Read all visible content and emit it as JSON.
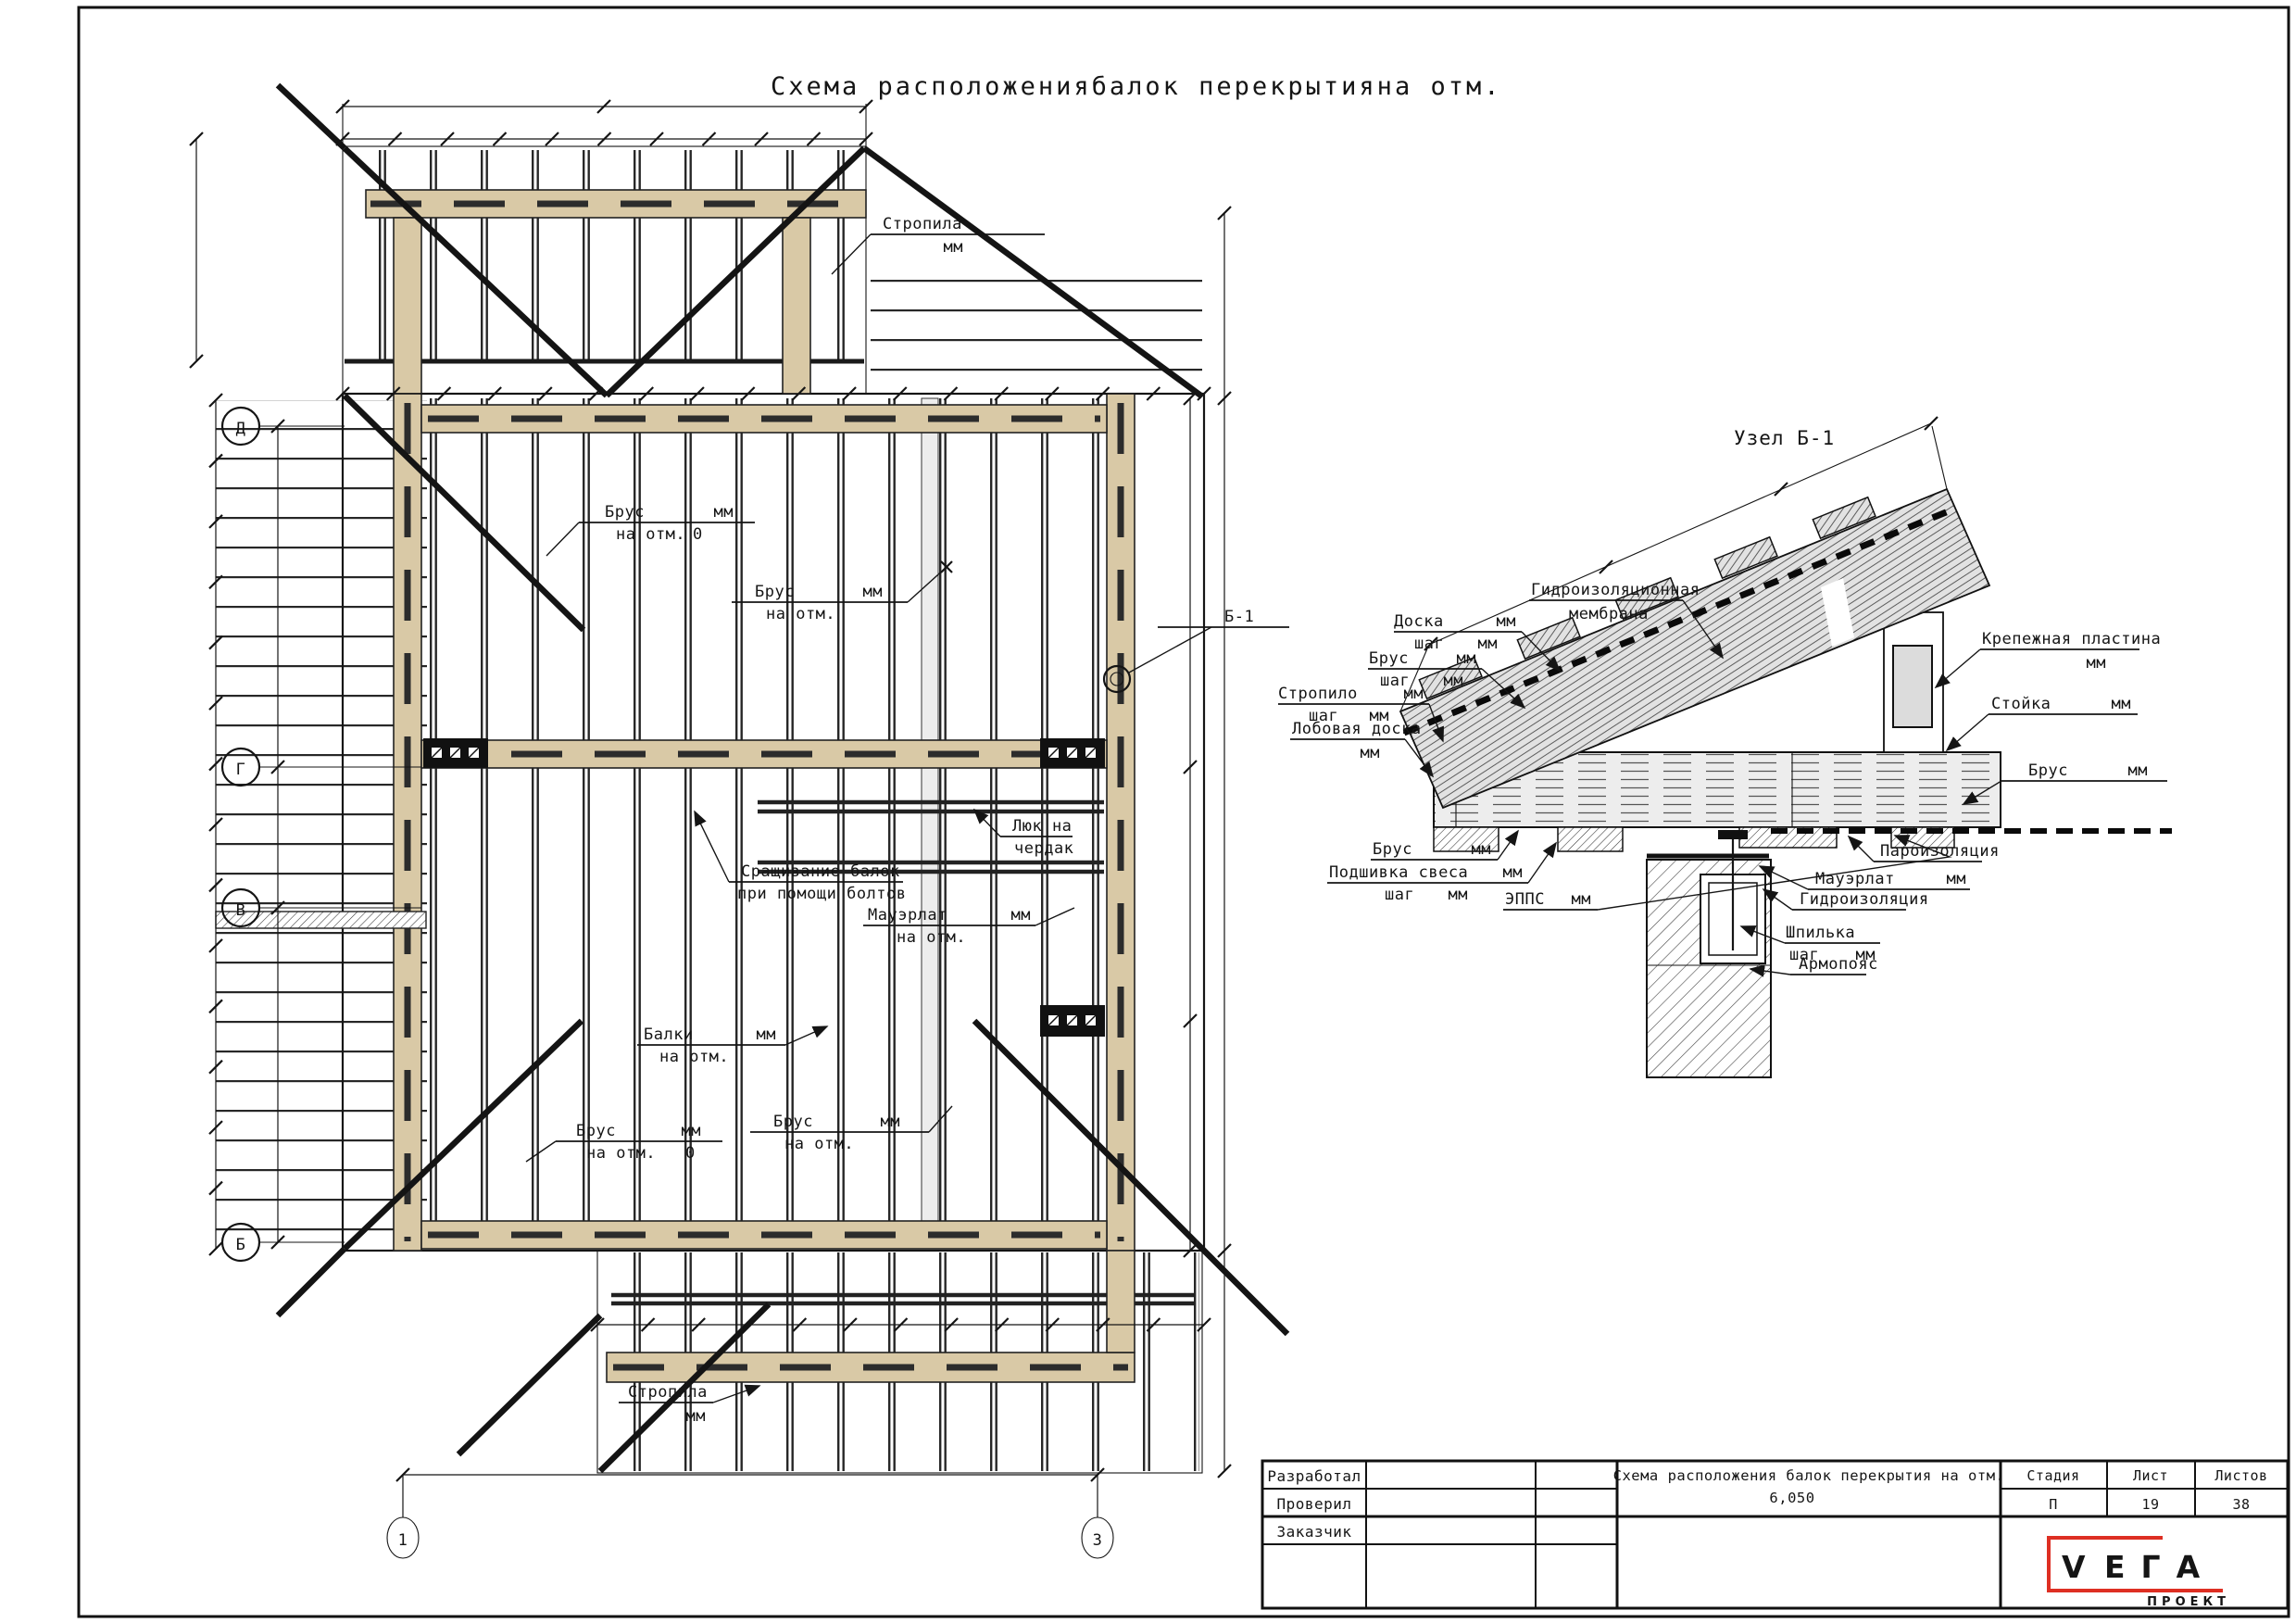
{
  "sheet": {
    "title": "Схема расположениябалок перекрытияна отм."
  },
  "plan": {
    "axes_left": [
      "Д",
      "Г",
      "В",
      "Б"
    ],
    "axes_bottom": [
      "1",
      "3"
    ],
    "node_ref": "Б-1",
    "labels": {
      "stropila_top": {
        "top": "Стропила",
        "bot": "мм"
      },
      "brus_tl": {
        "top": "Брус",
        "top2": "мм",
        "bot": "на отм.",
        "bot2": "0"
      },
      "brus_tm": {
        "top": "Брус",
        "top2": "мм",
        "bot": "на отм."
      },
      "luk": {
        "top": "Люк на",
        "bot": "чердак"
      },
      "srashchivanie": {
        "top": "Сращивание балок",
        "bot": "при помощи болтов"
      },
      "mauerlat": {
        "top": "Мауэрлат",
        "top2": "мм",
        "bot": "на отм."
      },
      "balki": {
        "top": "Балки",
        "top2": "мм",
        "bot": "на отм."
      },
      "brus_bl": {
        "top": "Брус",
        "top2": "мм",
        "bot": "на отм.",
        "bot2": "0"
      },
      "brus_bm": {
        "top": "Брус",
        "top2": "мм",
        "bot": "на отм."
      },
      "stropila_bottom": {
        "top": "Стропила",
        "bot": "мм"
      }
    }
  },
  "detail": {
    "title": "Узел Б-1",
    "labels": {
      "membrana": {
        "top": "Гидроизоляционная",
        "bot": "мембрана"
      },
      "doska": {
        "top": "Доска",
        "top2": "мм",
        "bot": "шаг",
        "bot2": "мм"
      },
      "brus_roof": {
        "top": "Брус",
        "top2": "мм",
        "bot": "шаг",
        "bot2": "мм"
      },
      "stropilo": {
        "top": "Стропило",
        "top2": "мм",
        "bot": "шаг",
        "bot2": "мм"
      },
      "lobovaya": {
        "top": "Лобовая доска",
        "bot": "мм"
      },
      "brus_left": {
        "top": "Брус",
        "top2": "мм"
      },
      "podshivka": {
        "top": "Подшивка свеса",
        "top2": "мм",
        "bot": "шаг",
        "bot2": "мм"
      },
      "epps": {
        "top": "ЭППС",
        "top2": "мм"
      },
      "krepezh": {
        "top": "Крепежная пластина",
        "bot": "мм"
      },
      "stoyka": {
        "top": "Стойка",
        "top2": "мм"
      },
      "brus_right": {
        "top": "Брус",
        "top2": "мм"
      },
      "paro": {
        "top": "Пароизоляция"
      },
      "mauerlat_d": {
        "top": "Мауэрлат",
        "top2": "мм"
      },
      "gidro": {
        "top": "Гидроизоляция"
      },
      "shpilka": {
        "top": "Шпилька",
        "bot": "шаг",
        "bot2": "мм"
      },
      "armopoyas": {
        "top": "Армопояс"
      }
    }
  },
  "titleblock": {
    "rows": [
      "Разработал",
      "Проверил",
      "Заказчик"
    ],
    "doc_title": "Схема расположения балок перекрытия на отм.",
    "doc_elev": "6,050",
    "stage_label": "Стадия",
    "sheet_label": "Лист",
    "sheets_label": "Листов",
    "stage": "П",
    "sheet": "19",
    "sheets": "38",
    "logo": {
      "v": "V",
      "rest": "ЕГА",
      "sub": "ПРОЕКТ"
    }
  },
  "colors": {
    "wood": "#d9c9a6",
    "logo_red": "#de2f23",
    "line": "#1a1a1a"
  }
}
